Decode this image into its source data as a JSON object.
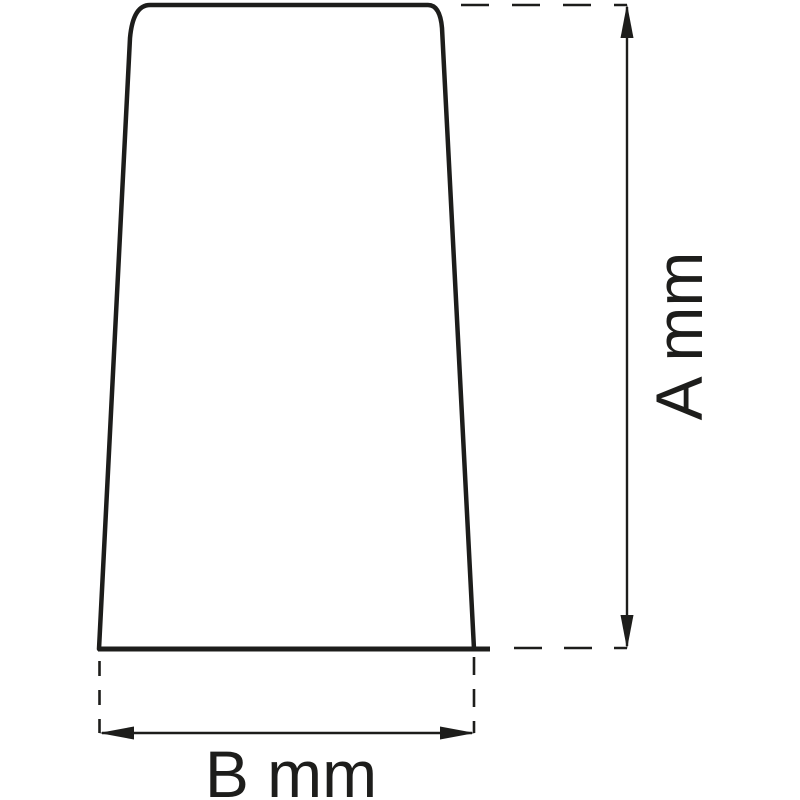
{
  "diagram": {
    "labels": {
      "vertical_dimension": "A mm",
      "horizontal_dimension": "B mm"
    },
    "colors": {
      "line": "#1d1d1b",
      "background": "#ffffff"
    }
  }
}
